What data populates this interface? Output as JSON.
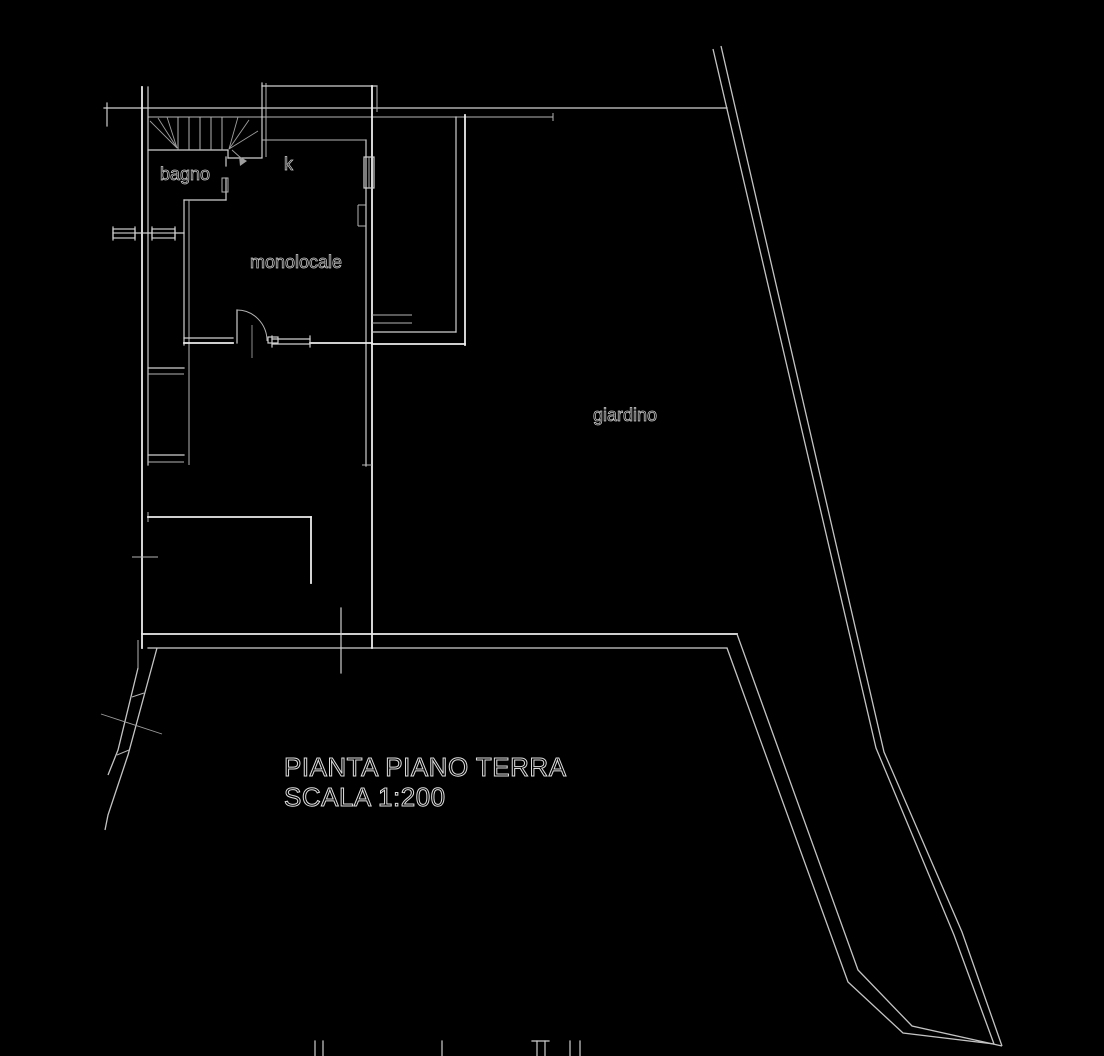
{
  "drawing": {
    "type": "architectural floor plan",
    "colors": {
      "background": "#000000",
      "wall_line": "#ededed",
      "detail_line": "#cfcfcf",
      "boundary_line": "#c4c4c4",
      "text_outline": "#dedede"
    },
    "rooms": {
      "bathroom_label": "bagno",
      "kitchen_label": "k",
      "studio_label": "monolocale",
      "garden_label": "giardino"
    },
    "title_block": {
      "line1": "PIANTA PIANO TERRA",
      "line2": "SCALA 1:200"
    }
  }
}
